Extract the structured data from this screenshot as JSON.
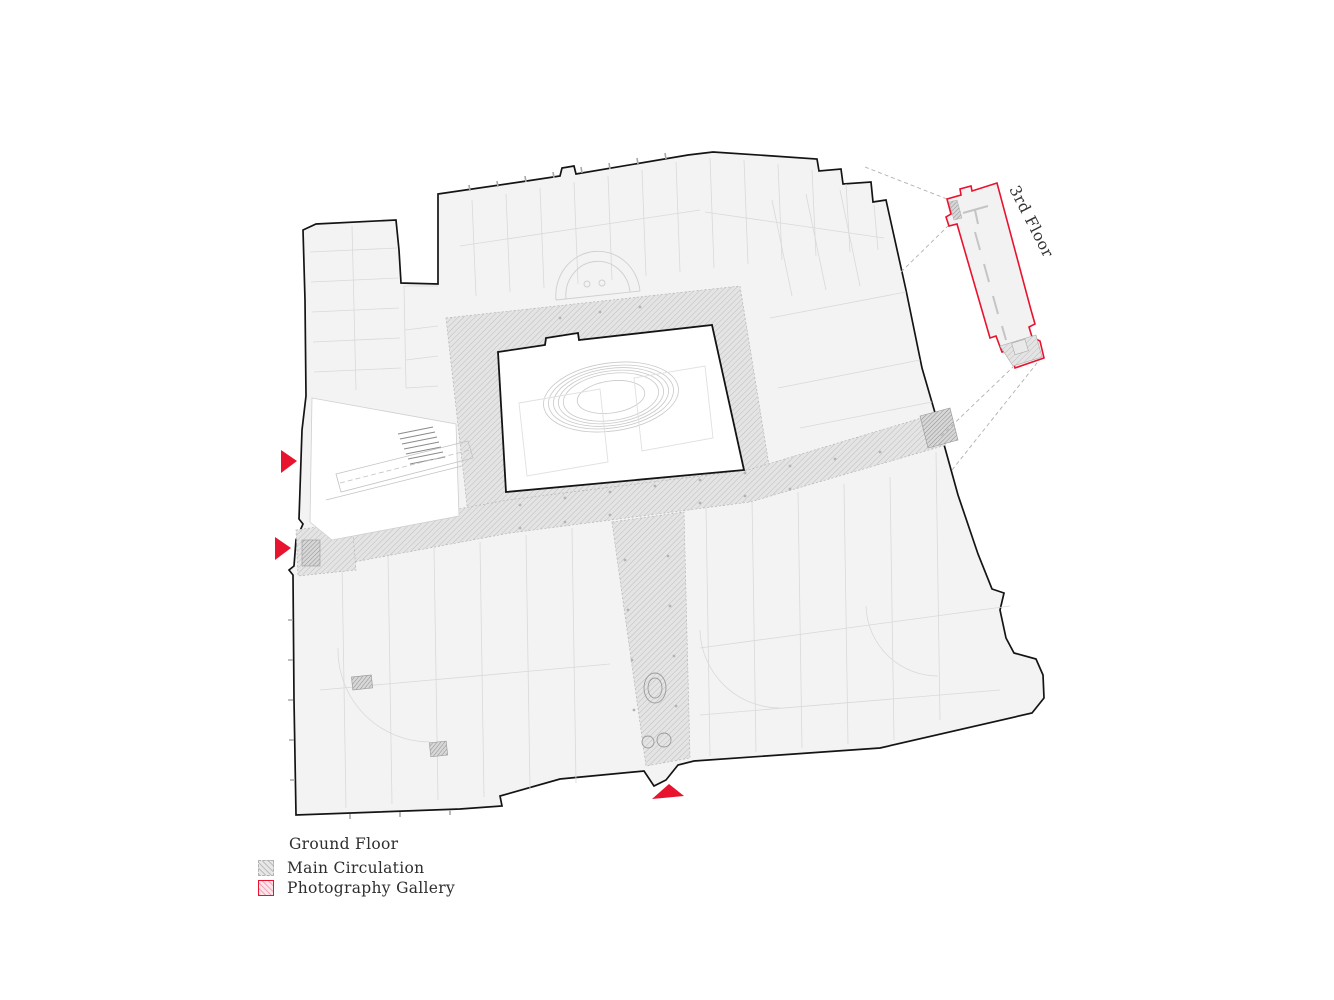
{
  "plan": {
    "inset_label": "3rd Floor",
    "legend": {
      "title": "Ground Floor",
      "items": [
        {
          "label": "Main Circulation",
          "swatch": "gray-hatch"
        },
        {
          "label": "Photography Gallery",
          "swatch": "red-hatch"
        }
      ]
    },
    "colors": {
      "accent_red": "#e8132f",
      "building_fill": "#f3f3f3",
      "building_outline": "#141414",
      "circulation_fill": "#e4e4e4",
      "circulation_hatch": "#bdbdbd",
      "gallery_fill": "#fbe3e9",
      "gallery_hatch": "#f0a9b8"
    },
    "markers": [
      {
        "name": "west-entrance-upper",
        "direction": "right"
      },
      {
        "name": "west-entrance-lower",
        "direction": "right"
      },
      {
        "name": "south-main-entrance",
        "direction": "up"
      }
    ]
  }
}
